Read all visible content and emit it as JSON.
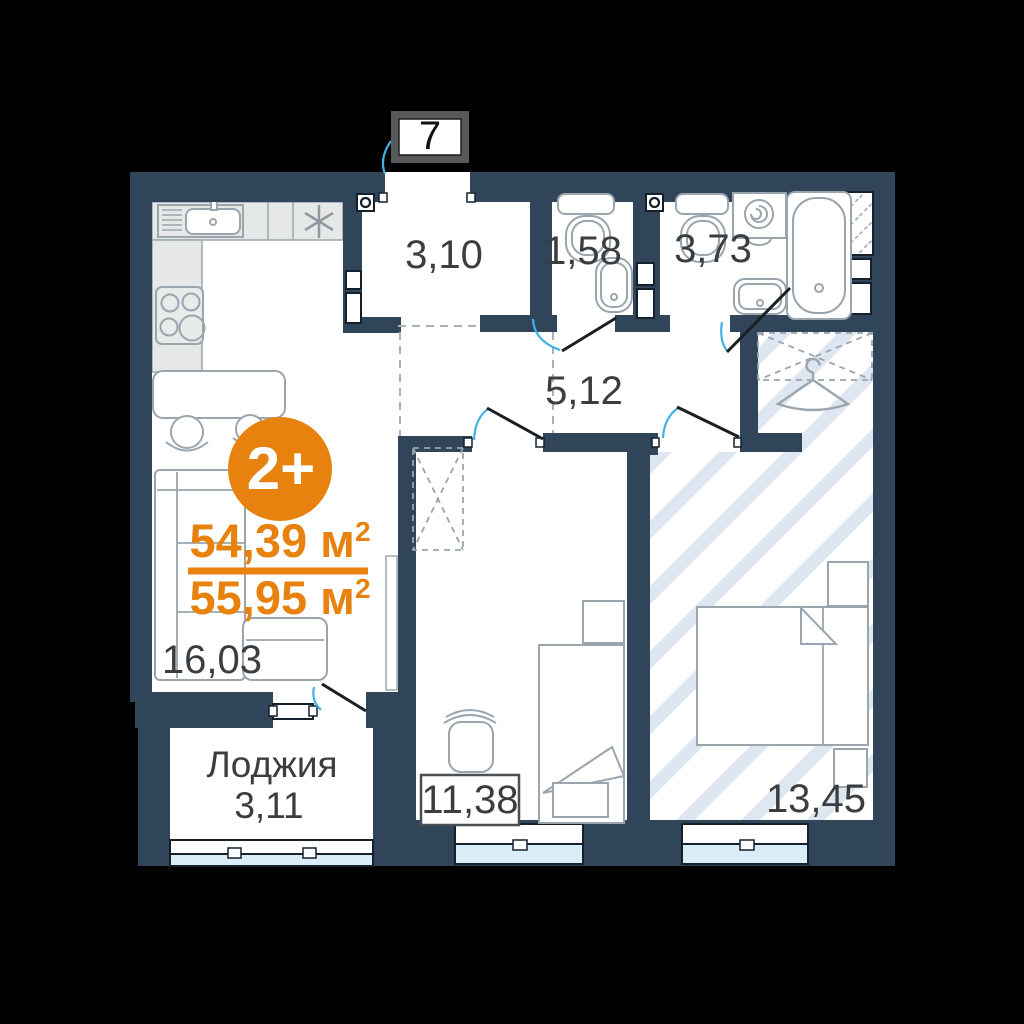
{
  "floorplan": {
    "unit_number": "7",
    "layout_badge": "2+",
    "living_area": {
      "value": "54,39",
      "unit": " м",
      "sup": "2"
    },
    "total_area": {
      "value": "55,95",
      "unit": " м",
      "sup": "2"
    },
    "rooms": {
      "hallway": "3,10",
      "wc": "1,58",
      "bathroom": "3,73",
      "corridor": "5,12",
      "kitchen_living": "16,03",
      "bedroom": "11,38",
      "master_bedroom": "13,45",
      "loggia_label": "Лоджия",
      "loggia_area": "3,11"
    },
    "colors": {
      "wall": "#31455a",
      "accent_orange": "#e8820f",
      "door_arc": "#41b1e6",
      "floor_stripe": "#dde6f1",
      "window_glass": "#d9edf9",
      "kitchen_counter": "#e6e8e8",
      "furniture_outline": "#9aa5ad",
      "label_text": "#3a3e41"
    }
  }
}
